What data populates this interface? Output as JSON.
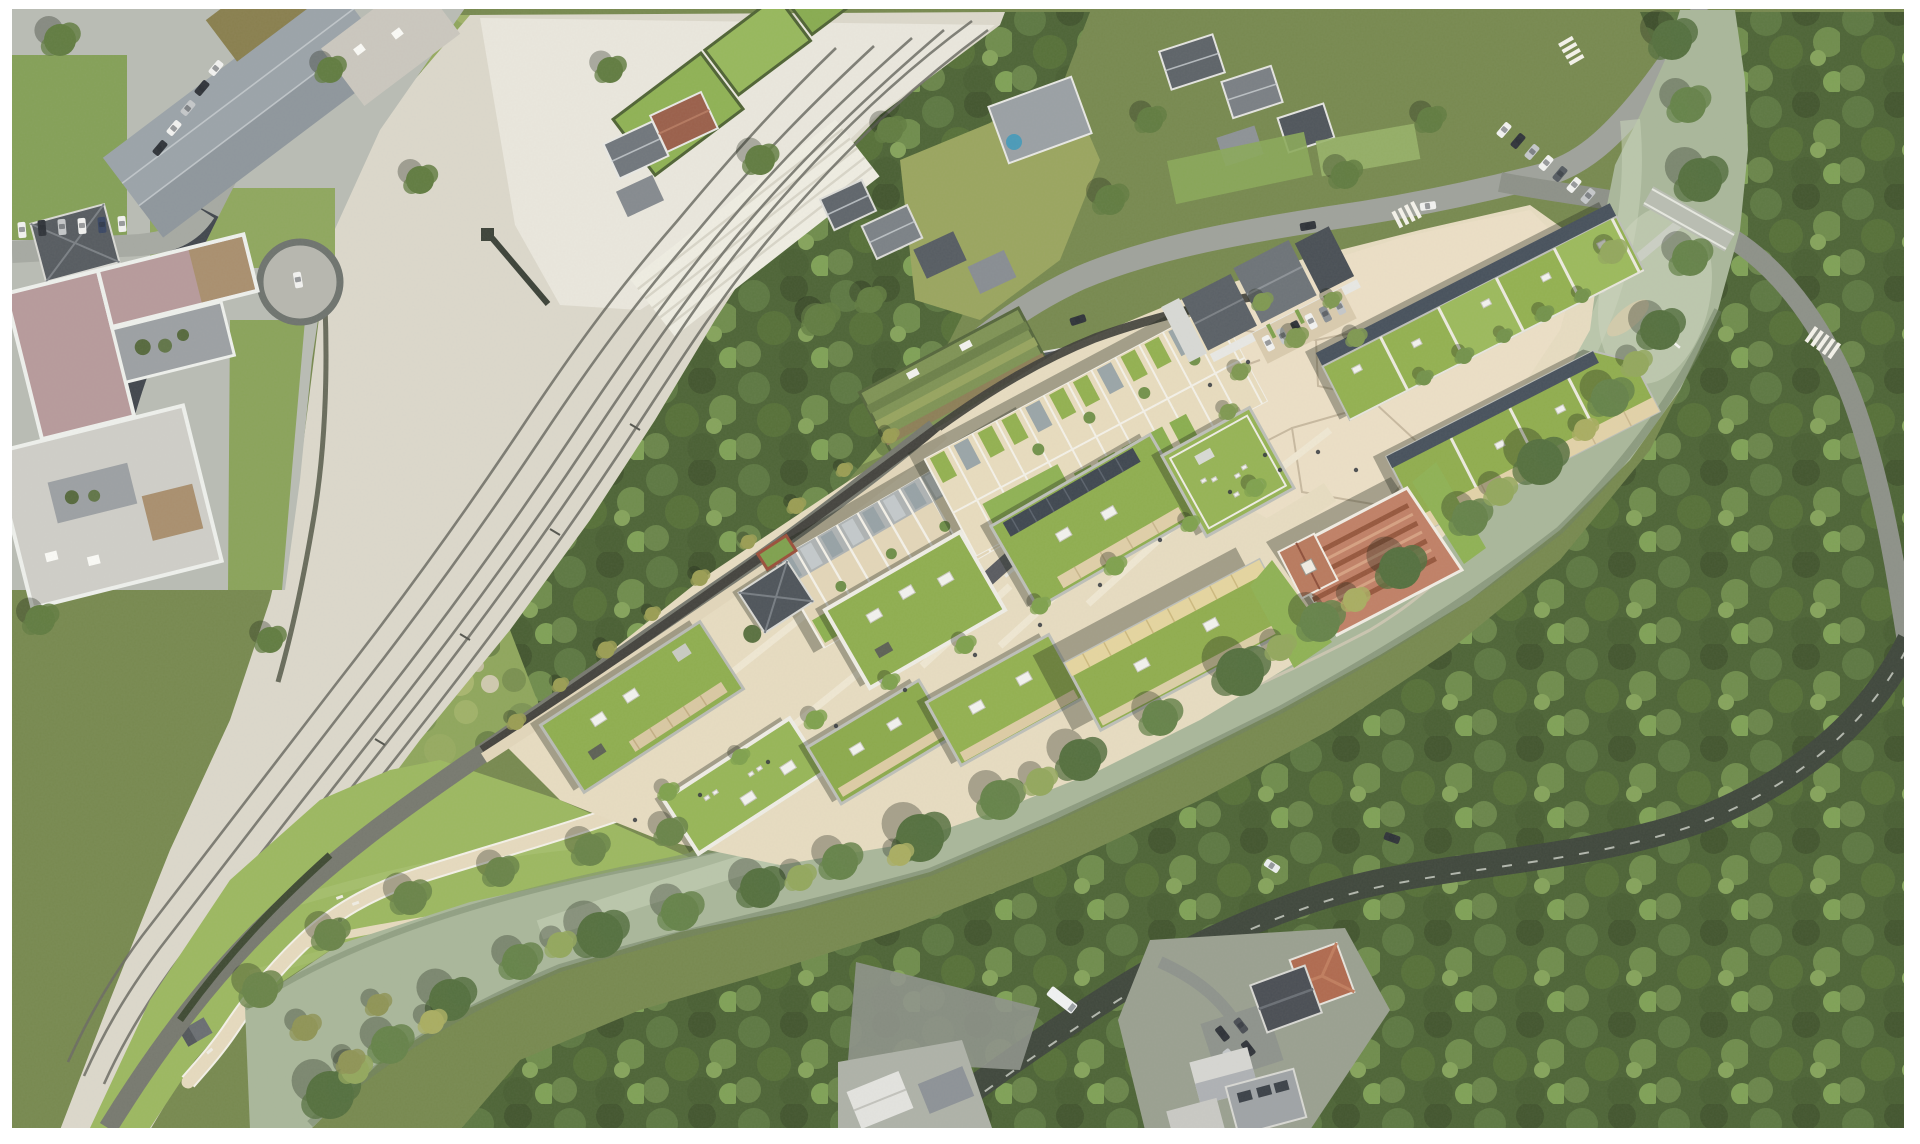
{
  "meta": {
    "title": "Aerial masterplan photomontage",
    "description": "Top-down aerial photograph of a river valley with railway corridor, existing village, forest, and a rendered riverside redevelopment masterplan of green-roof housing blocks, terraced houses, a terracotta-roofed hall, plazas and a riverside park. No text or UI chrome is present in the image.",
    "view": "orthographic aerial / site plan render"
  },
  "palette": {
    "frame": "#ffffff",
    "canopy_dark": "#4d6436",
    "canopy_mid": "#617c41",
    "canopy_light": "#7d9a52",
    "canopy_accent": "#a2ad62",
    "scrub": "#8fa65c",
    "meadow": "#9cb860",
    "meadow_light": "#abc274",
    "ballast": "#dcd8cb",
    "ballast_light": "#eae7dd",
    "track": "#6b6b63",
    "asphalt": "#a6a9a2",
    "asphalt_new": "#41464d",
    "road_shaded": "#3f473c",
    "water": "#a9b79a",
    "water_light": "#c8d1b7",
    "water_dark": "#7e8e71",
    "sand": "#d6cbaa",
    "path": "#e6dabe",
    "plaza": "#ecdfc6",
    "plaza_line": "#c4b59b",
    "site_street": "#595b60",
    "roof_green": "#8fae4f",
    "roof_green_light": "#9cba5c",
    "parapet": "#bdbfb8",
    "white_trim": "#efede5",
    "facade_dark": "#47515c",
    "terracotta": "#c08066",
    "terracotta_dark": "#96573d",
    "terracotta_light": "#d6a182",
    "roof_slate": "#4e545a",
    "roof_gray": "#7e8489",
    "roof_pink": "#b79a9b",
    "roof_tan": "#a98f6e",
    "courtyard": "#9ca0a3",
    "pool": "#4a9ab8",
    "car_white": "#f2f2f0",
    "car_dark": "#30343a",
    "car_silver": "#c4c7c9"
  },
  "scene": {
    "features": [
      {
        "name": "railway-corridor",
        "kind": "infrastructure",
        "position": "diagonal band, top-centre to bottom-left"
      },
      {
        "name": "urban-block-northwest",
        "kind": "existing buildings",
        "position": "top-left"
      },
      {
        "name": "school-complex-pink-roof",
        "kind": "existing building",
        "position": "left"
      },
      {
        "name": "village-street-houses",
        "kind": "existing buildings",
        "position": "top-centre and top-right"
      },
      {
        "name": "allotment-gardens",
        "kind": "landscape",
        "position": "above site"
      },
      {
        "name": "masterplan-site",
        "kind": "proposed development",
        "position": "centre-right diagonal band"
      },
      {
        "name": "green-roof-apartment-blocks",
        "kind": "proposed buildings",
        "count": 10
      },
      {
        "name": "terraced-housing-rows",
        "kind": "proposed buildings",
        "count": 2
      },
      {
        "name": "market-hall-terracotta-roof",
        "kind": "proposed building",
        "position": "right of centre"
      },
      {
        "name": "central-plaza-with-parking",
        "kind": "public space",
        "position": "upper right of site"
      },
      {
        "name": "riverside-esplanade",
        "kind": "public space",
        "position": "along river"
      },
      {
        "name": "meadow-park-with-promenade",
        "kind": "landscape",
        "position": "bottom-left"
      },
      {
        "name": "kiosk-pavilion",
        "kind": "small structure",
        "position": "lower-left promenade"
      },
      {
        "name": "river",
        "kind": "water",
        "position": "curving from bottom-left to top-right"
      },
      {
        "name": "weir-footbridge",
        "kind": "infrastructure",
        "position": "river pool, right"
      },
      {
        "name": "road-bridge",
        "kind": "infrastructure",
        "position": "top-right"
      },
      {
        "name": "east-bank-road",
        "kind": "infrastructure",
        "position": "right and bottom-centre, under trees"
      },
      {
        "name": "zebra-crossings",
        "kind": "road marking",
        "count": 2
      },
      {
        "name": "residential-cluster-south",
        "kind": "existing buildings",
        "position": "bottom-centre-right"
      },
      {
        "name": "riverside-forest",
        "kind": "landscape",
        "position": "right and bottom"
      }
    ]
  }
}
